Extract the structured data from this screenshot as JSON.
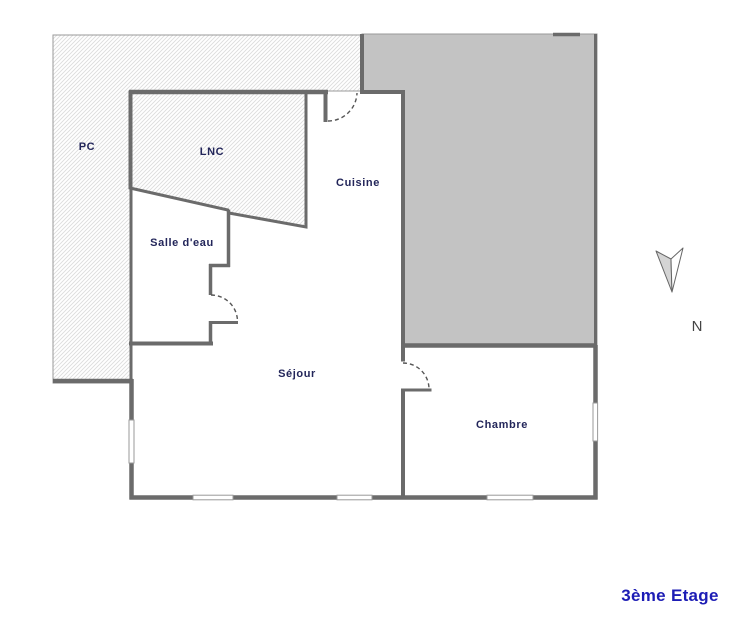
{
  "floor_plan": {
    "rooms": {
      "pc": "PC",
      "lnc": "LNC",
      "cuisine": "Cuisine",
      "salle_deau": "Salle d'eau",
      "sejour": "Séjour",
      "chambre": "Chambre"
    },
    "compass_label": "N",
    "floor_title": "3ème Etage",
    "colors": {
      "wall": "#6b6b6b",
      "hatch_line": "#dcdcdc",
      "gray_area": "#c3c3c3",
      "room_label": "#23265a",
      "floor_title_blue": "#1d1db5",
      "door_arc": "#555555",
      "compass": "#444444"
    }
  }
}
